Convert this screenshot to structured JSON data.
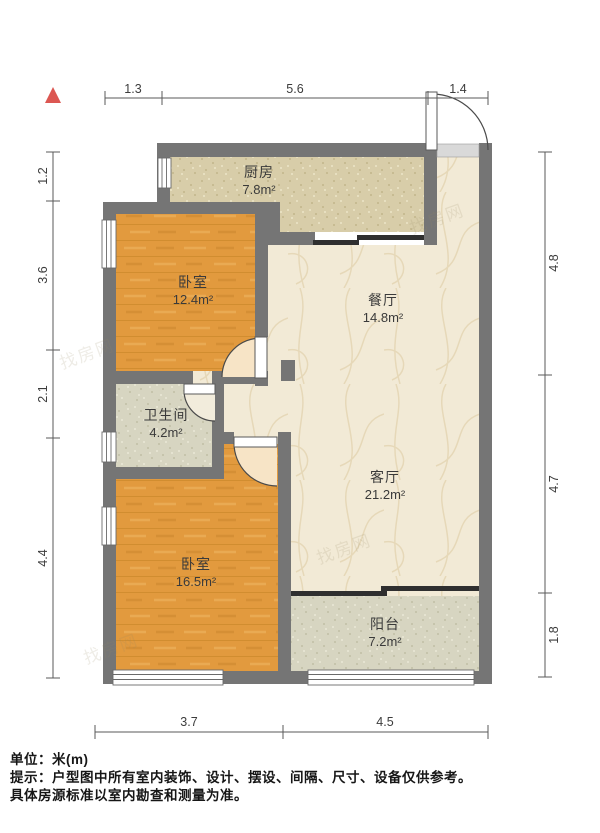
{
  "title": "户型图",
  "rooms": [
    {
      "id": "kitchen",
      "name": "厨房",
      "area": "7.8m²"
    },
    {
      "id": "bedroom1",
      "name": "卧室",
      "area": "12.4m²"
    },
    {
      "id": "dining",
      "name": "餐厅",
      "area": "14.8m²"
    },
    {
      "id": "bathroom",
      "name": "卫生间",
      "area": "4.2m²"
    },
    {
      "id": "living",
      "name": "客厅",
      "area": "21.2m²"
    },
    {
      "id": "bedroom2",
      "name": "卧室",
      "area": "16.5m²"
    },
    {
      "id": "balcony",
      "name": "阳台",
      "area": "7.2m²"
    }
  ],
  "dimensions": {
    "top": [
      "1.3",
      "5.6",
      "1.4"
    ],
    "bottom": [
      "3.7",
      "4.5"
    ],
    "left": [
      "1.2",
      "3.6",
      "2.1",
      "4.4"
    ],
    "right": [
      "4.8",
      "4.7",
      "1.8"
    ]
  },
  "footer": {
    "unit_label": "单位：米(m)",
    "tip_line1": "提示：户型图中所有室内装饰、设计、摆设、间隔、尺寸、设备仅供参考。",
    "tip_line2": "具体房源标准以室内勘查和测量为准。"
  },
  "watermark": {
    "text": "找房网"
  },
  "colors": {
    "wall": "#757575",
    "bedroom_floor": "#e29a3e",
    "living_floor": "#f2ead6",
    "kitchen_floor": "#d8cda9",
    "bath_floor": "#d6d4c0",
    "balcony_floor": "#d9d8c6",
    "door_swing": "#f7e4c6",
    "compass": "#dc5752"
  }
}
